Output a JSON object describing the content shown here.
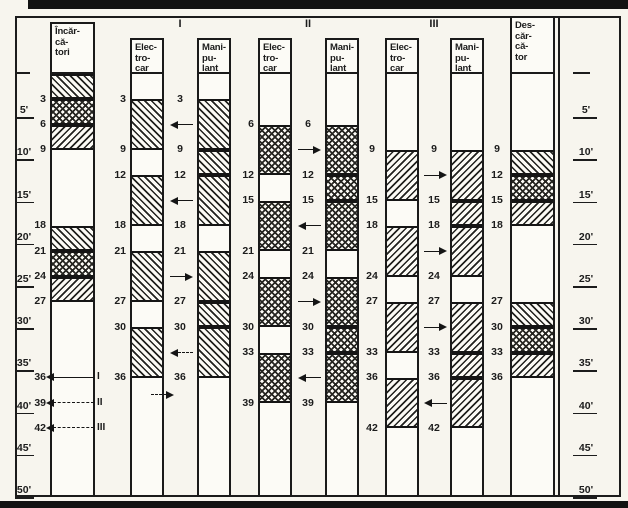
{
  "group_labels": [
    "I",
    "II",
    "III"
  ],
  "time_scale": {
    "zero_mark": "—",
    "ticks": [
      "5'",
      "10'",
      "15'",
      "20'",
      "25'",
      "30'",
      "35'",
      "40'",
      "45'",
      "50'"
    ],
    "tick_minutes": [
      5,
      10,
      15,
      20,
      25,
      30,
      35,
      40,
      45,
      50
    ]
  },
  "columns": {
    "incarcatori": {
      "header": [
        "Încăr-",
        "că-",
        "tori"
      ],
      "blocks": [
        {
          "from": 0,
          "to": 3,
          "hatch": "fwd"
        },
        {
          "from": 3,
          "to": 6,
          "hatch": "cross"
        },
        {
          "from": 6,
          "to": 9,
          "hatch": "back"
        },
        {
          "from": 18,
          "to": 21,
          "hatch": "fwd"
        },
        {
          "from": 21,
          "to": 24,
          "hatch": "cross"
        },
        {
          "from": 24,
          "to": 27,
          "hatch": "back"
        }
      ]
    },
    "electrocar1": {
      "header": [
        "Elec-",
        "tro-",
        "car"
      ],
      "blocks": [
        {
          "from": 3,
          "to": 9,
          "hatch": "fwd"
        },
        {
          "from": 12,
          "to": 18,
          "hatch": "fwd"
        },
        {
          "from": 21,
          "to": 27,
          "hatch": "fwd"
        },
        {
          "from": 30,
          "to": 36,
          "hatch": "fwd"
        }
      ]
    },
    "manipulant1": {
      "header": [
        "Mani-",
        "pu-",
        "lant"
      ],
      "blocks": [
        {
          "from": 3,
          "to": 9,
          "hatch": "fwd"
        },
        {
          "from": 9,
          "to": 12,
          "hatch": "fwd"
        },
        {
          "from": 12,
          "to": 18,
          "hatch": "fwd"
        },
        {
          "from": 21,
          "to": 27,
          "hatch": "fwd"
        },
        {
          "from": 27,
          "to": 30,
          "hatch": "fwd"
        },
        {
          "from": 30,
          "to": 36,
          "hatch": "fwd"
        }
      ]
    },
    "electrocar2": {
      "header": [
        "Elec-",
        "tro-",
        "car"
      ],
      "blocks": [
        {
          "from": 6,
          "to": 12,
          "hatch": "cross"
        },
        {
          "from": 15,
          "to": 21,
          "hatch": "cross"
        },
        {
          "from": 24,
          "to": 30,
          "hatch": "cross"
        },
        {
          "from": 33,
          "to": 39,
          "hatch": "cross"
        }
      ]
    },
    "manipulant2": {
      "header": [
        "Mani-",
        "pu-",
        "lant"
      ],
      "blocks": [
        {
          "from": 6,
          "to": 12,
          "hatch": "cross"
        },
        {
          "from": 12,
          "to": 15,
          "hatch": "cross"
        },
        {
          "from": 15,
          "to": 21,
          "hatch": "cross"
        },
        {
          "from": 24,
          "to": 30,
          "hatch": "cross"
        },
        {
          "from": 30,
          "to": 33,
          "hatch": "cross"
        },
        {
          "from": 33,
          "to": 39,
          "hatch": "cross"
        }
      ]
    },
    "electrocar3": {
      "header": [
        "Elec-",
        "tro-",
        "car"
      ],
      "blocks": [
        {
          "from": 9,
          "to": 15,
          "hatch": "back"
        },
        {
          "from": 18,
          "to": 24,
          "hatch": "back"
        },
        {
          "from": 27,
          "to": 33,
          "hatch": "back"
        },
        {
          "from": 36,
          "to": 42,
          "hatch": "back"
        }
      ]
    },
    "manipulant3": {
      "header": [
        "Mani-",
        "pu-",
        "lant"
      ],
      "blocks": [
        {
          "from": 9,
          "to": 15,
          "hatch": "back"
        },
        {
          "from": 15,
          "to": 18,
          "hatch": "back"
        },
        {
          "from": 18,
          "to": 24,
          "hatch": "back"
        },
        {
          "from": 27,
          "to": 33,
          "hatch": "back"
        },
        {
          "from": 33,
          "to": 36,
          "hatch": "back"
        },
        {
          "from": 36,
          "to": 42,
          "hatch": "back"
        }
      ]
    },
    "descarcator": {
      "header": [
        "Des-",
        "căr-",
        "că-",
        "tor"
      ],
      "blocks": [
        {
          "from": 9,
          "to": 12,
          "hatch": "fwd"
        },
        {
          "from": 12,
          "to": 15,
          "hatch": "cross"
        },
        {
          "from": 15,
          "to": 18,
          "hatch": "back"
        },
        {
          "from": 27,
          "to": 30,
          "hatch": "fwd"
        },
        {
          "from": 30,
          "to": 33,
          "hatch": "cross"
        },
        {
          "from": 33,
          "to": 36,
          "hatch": "back"
        }
      ]
    }
  },
  "number_rails": [
    {
      "id": "scale-left-numbers",
      "values": [
        3,
        6,
        9,
        18,
        21,
        24,
        27,
        36,
        39,
        42
      ]
    },
    {
      "id": "elec1-left-numbers",
      "values": [
        3,
        9,
        12,
        18,
        21,
        27,
        30,
        36
      ]
    },
    {
      "id": "group1-mid-numbers",
      "values": [
        3,
        9,
        12,
        18,
        21,
        27,
        30,
        36
      ]
    },
    {
      "id": "elec2-left-numbers",
      "values": [
        6,
        12,
        15,
        21,
        24,
        30,
        33,
        39
      ]
    },
    {
      "id": "group2-mid-numbers",
      "values": [
        6,
        12,
        15,
        21,
        24,
        30,
        33,
        39
      ]
    },
    {
      "id": "elec3-left-numbers",
      "values": [
        9,
        15,
        18,
        24,
        27,
        33,
        36,
        42
      ]
    },
    {
      "id": "group3-mid-numbers",
      "values": [
        9,
        15,
        18,
        24,
        27,
        33,
        36,
        42
      ]
    },
    {
      "id": "descarcator-left-numbers",
      "values": [
        9,
        12,
        15,
        18,
        27,
        30,
        33,
        36
      ]
    }
  ],
  "travel_arrows": {
    "group1": [
      {
        "t": 6,
        "dir": "left",
        "dashed": false
      },
      {
        "t": 15,
        "dir": "left",
        "dashed": false
      },
      {
        "t": 24,
        "dir": "right",
        "dashed": false
      },
      {
        "t": 33,
        "dir": "left",
        "dashed": true
      }
    ],
    "group2": [
      {
        "t": 9,
        "dir": "right",
        "dashed": false
      },
      {
        "t": 18,
        "dir": "left",
        "dashed": false
      },
      {
        "t": 27,
        "dir": "right",
        "dashed": false
      },
      {
        "t": 36,
        "dir": "left",
        "dashed": false
      }
    ],
    "group3": [
      {
        "t": 12,
        "dir": "right",
        "dashed": false
      },
      {
        "t": 21,
        "dir": "right",
        "dashed": false
      },
      {
        "t": 30,
        "dir": "right",
        "dashed": false
      },
      {
        "t": 39,
        "dir": "left",
        "dashed": false
      }
    ]
  },
  "return_arrows": [
    {
      "t": 36,
      "label": "I",
      "line": "solid"
    },
    {
      "t": 39,
      "label": "II",
      "line": "dashdot"
    },
    {
      "t": 42,
      "label": "III",
      "line": "dashed"
    }
  ],
  "extra_arrow": {
    "t": 38,
    "dir": "right",
    "dashed": true
  },
  "colors": {
    "ink": "#1c1c1c",
    "paper": "#f7f5ee",
    "column_bg": "#fcfbf6"
  }
}
